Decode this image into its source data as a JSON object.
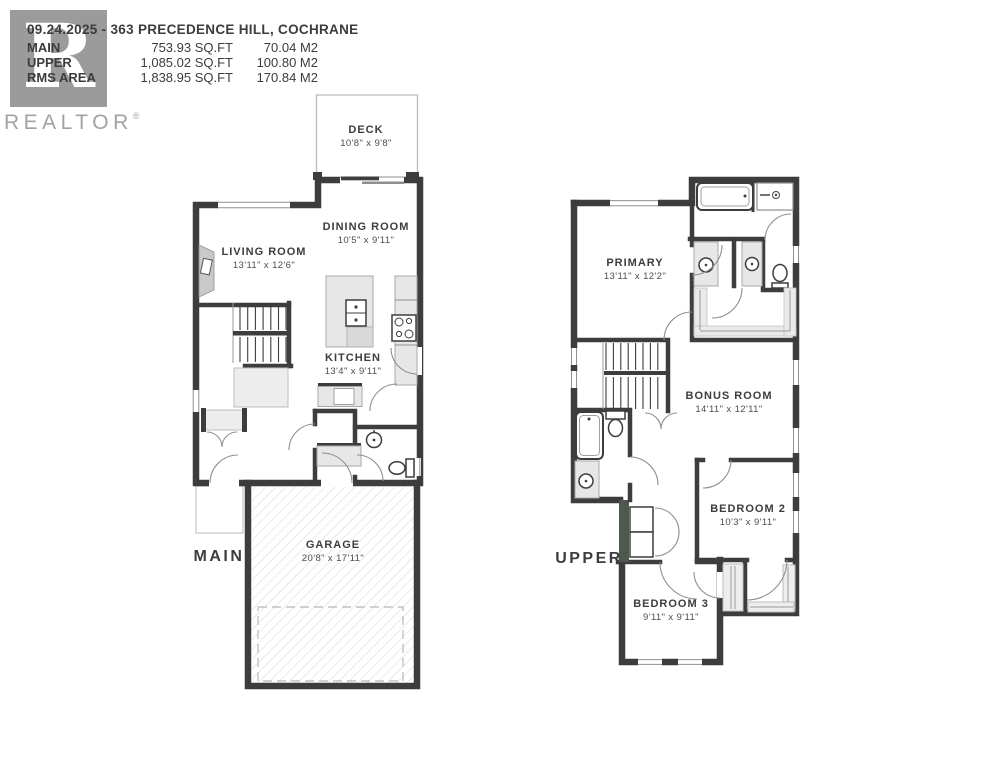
{
  "header": {
    "title": "09.24.2025 - 363 PRECEDENCE HILL, COCHRANE",
    "area_rows": [
      {
        "label": "MAIN",
        "sqft": "753.93 SQ.FT",
        "m2": "70.04 M2"
      },
      {
        "label": "UPPER",
        "sqft": "1,085.02 SQ.FT",
        "m2": "100.80 M2"
      },
      {
        "label": "RMS AREA",
        "sqft": "1,838.95 SQ.FT",
        "m2": "170.84 M2"
      }
    ]
  },
  "logo": {
    "letter": "R",
    "wordmark": "REALTOR",
    "registered": "®"
  },
  "floors": {
    "main": {
      "label": "MAIN",
      "rooms": {
        "deck": {
          "name": "DECK",
          "dims": "10'8\" x 9'8\""
        },
        "dining": {
          "name": "DINING ROOM",
          "dims": "10'5\" x 9'11\""
        },
        "living": {
          "name": "LIVING ROOM",
          "dims": "13'11\" x 12'6\""
        },
        "kitchen": {
          "name": "KITCHEN",
          "dims": "13'4\" x 9'11\""
        },
        "garage": {
          "name": "GARAGE",
          "dims": "20'8\" x 17'11\""
        }
      }
    },
    "upper": {
      "label": "UPPER",
      "rooms": {
        "primary": {
          "name": "PRIMARY",
          "dims": "13'11\" x 12'2\""
        },
        "bonus": {
          "name": "BONUS ROOM",
          "dims": "14'11\" x 12'11\""
        },
        "bedroom2": {
          "name": "BEDROOM 2",
          "dims": "10'3\" x 9'11\""
        },
        "bedroom3": {
          "name": "BEDROOM 3",
          "dims": "9'11\" x 9'11\""
        }
      }
    }
  },
  "colors": {
    "wall": "#3d3d3d",
    "fixture_fill": "#e7e7e7",
    "hatch": "#dcdcdc",
    "logo_gray": "#9b9b9b",
    "laundry_wall": "#4e584f"
  }
}
